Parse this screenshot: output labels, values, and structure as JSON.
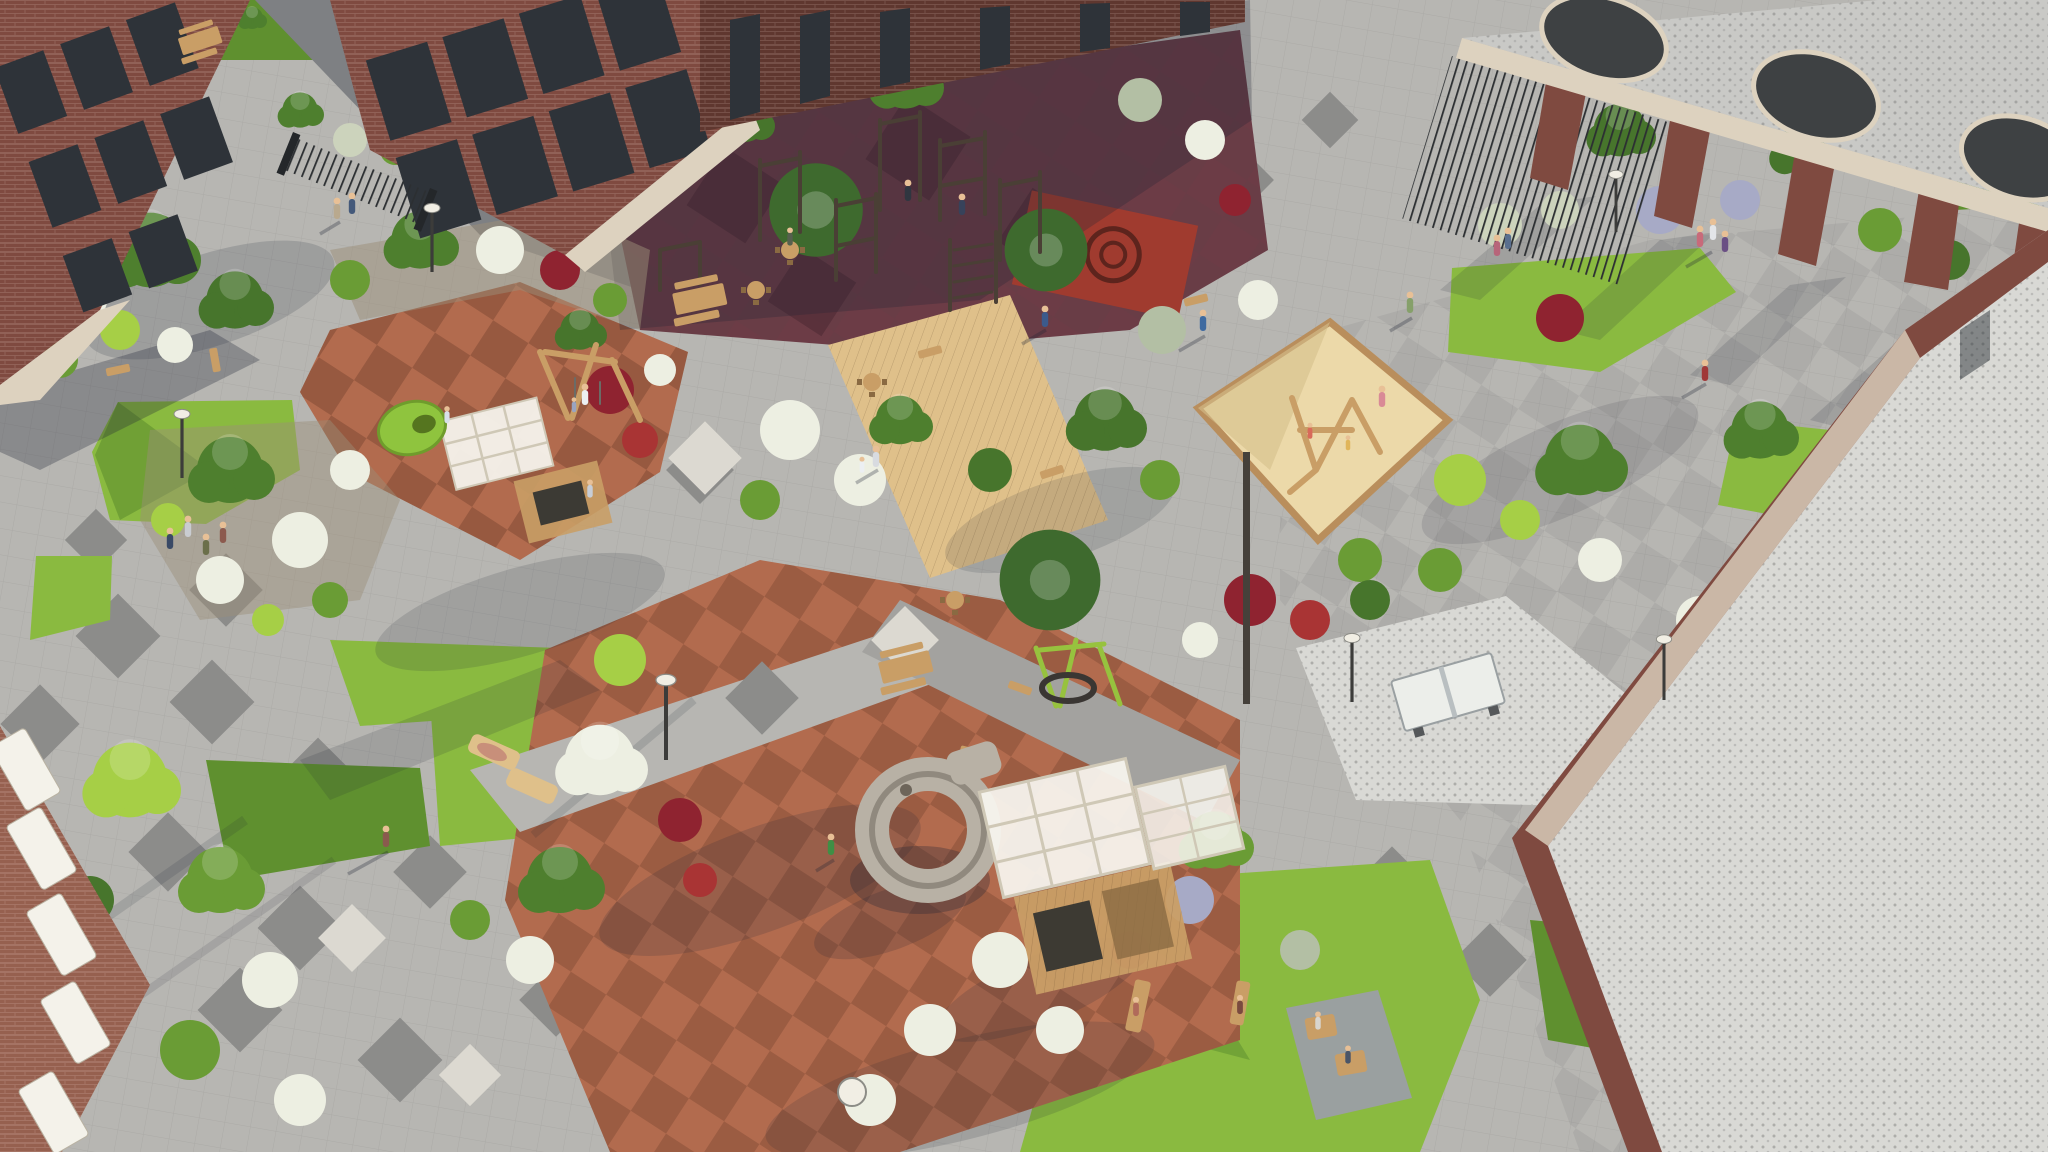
{
  "meta": {
    "title": "Aerial architectural rendering of a residential courtyard with playgrounds, landscaping and brick apartment buildings",
    "view": "aerial three-quarter",
    "lighting": "sunny, long shadows cast toward lower-left"
  },
  "palette": {
    "paving": "#b7b6b2",
    "paving_mid": "#a3a29f",
    "paving_dark": "#8c8c8a",
    "paving_white": "#dcd9d1",
    "asphalt": "#7e8083",
    "lawn": "#8aba40",
    "lawn_dark": "#5f902f",
    "lawn_shade": "#477029",
    "bush_green": "#6a9c35",
    "bush_lime": "#a6cf46",
    "bush_dark": "#47752c",
    "bush_white": "#edefe2",
    "bush_silver": "#ccd3bc",
    "bush_sage": "#b3bfa4",
    "bush_lavender": "#a7aac6",
    "bush_burgundy": "#8f2330",
    "bush_red": "#a93434",
    "tree_green": "#4e7f2e",
    "conifer": "#3e6a2e",
    "rubber_terracotta": "#b26b4e",
    "rubber_terra_dark": "#84503c",
    "rubber_brown": "#6f4434",
    "rubber_maroon": "#6c3c46",
    "rubber_maroon_dark": "#57303a",
    "rubber_red": "#a03b2f",
    "sand": "#ecd9a9",
    "sand_shade": "#d6bf8c",
    "wood": "#c99e66",
    "wood_light": "#dfc08a",
    "wood_dark": "#8a6a42",
    "brick": "#7f4a40",
    "brick_dark": "#5f372f",
    "brick_light": "#96604f",
    "trim": "#ddd2bf",
    "window": "#2e3339",
    "metal_dark": "#3b3e41",
    "slide_gray": "#b8b1a5",
    "white_struct": "#f4f2ea",
    "pebble": "#d9d9d5",
    "gravel_roof": "#c9c9c6",
    "mulch": "#9b8d77",
    "skin": "#e8c096",
    "shadow": "rgba(32,36,52,0.30)"
  },
  "scene": {
    "areas": [
      "paved plaza with diamond accent pavers",
      "calisthenics workout zone on maroon rubber",
      "children playground on terracotta rubber",
      "diamond sandbox with wooden climbing frame",
      "spiral tube slide",
      "climbing cube with white lattice roof",
      "nest swing",
      "table tennis table on gravel pad",
      "wooden deck seating with picnic tables",
      "lawns and mixed planting beds",
      "pergola canopy with round skylights",
      "brick apartment buildings with balconies"
    ],
    "vegetation": [
      "green shrubs",
      "lime topiary balls",
      "white flowering bushes",
      "burgundy barberry",
      "silver sage",
      "lavender",
      "conifers",
      "deciduous trees"
    ],
    "people_present": true
  }
}
